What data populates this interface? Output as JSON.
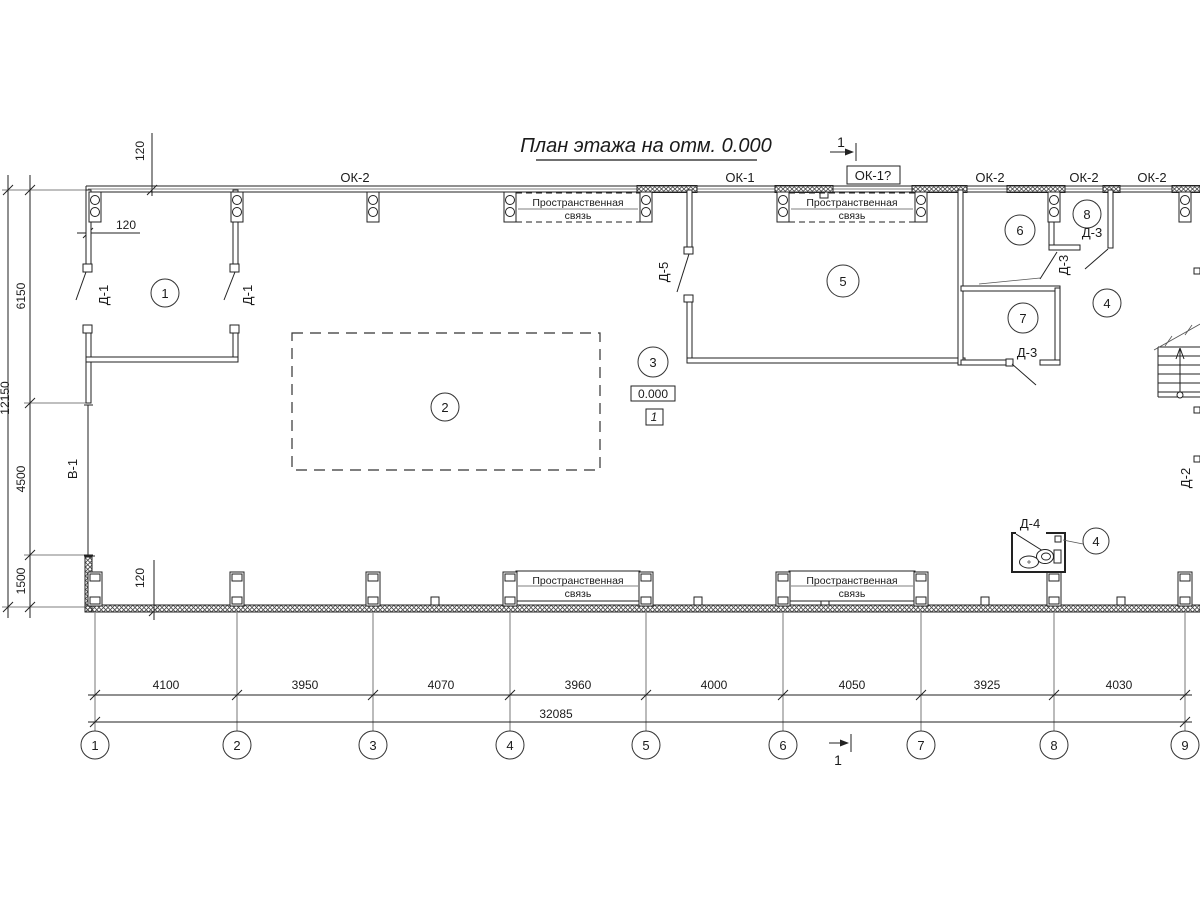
{
  "title": {
    "text": "План этажа на отм. 0.000"
  },
  "section_marks": {
    "top": "1",
    "bottom": "1"
  },
  "windows": {
    "ok2_a": "ОК-2",
    "ok1": "ОК-1",
    "ok1q": "ОК-1?",
    "ok2_b": "ОК-2",
    "ok2_c": "ОК-2",
    "ok2_d": "ОК-2"
  },
  "doors": {
    "d1_left": "Д-1",
    "d1_right": "Д-1",
    "d5": "Д-5",
    "d3_room8": "Д-3",
    "d3_mid": "Д-3",
    "d3_room7": "Д-3",
    "d4": "Д-4",
    "d2": "Д-2",
    "v1": "В-1"
  },
  "rooms": {
    "r1": "1",
    "r2": "2",
    "r3": "3",
    "r4a": "4",
    "r4b": "4",
    "r5": "5",
    "r6": "6",
    "r7": "7",
    "r8": "8"
  },
  "elevation": {
    "value": "0.000",
    "zone": "1"
  },
  "ties": {
    "line1": "Пространственная",
    "line2": "связь"
  },
  "dims": {
    "h": [
      "4100",
      "3950",
      "4070",
      "3960",
      "4000",
      "4050",
      "3925",
      "4030"
    ],
    "total": "32085",
    "v": [
      "6150",
      "4500",
      "1500"
    ],
    "v_total": "12150",
    "t120_top_v": "120",
    "t120_top_h": "120",
    "t120_bottom": "120"
  },
  "grid": {
    "axes": [
      "1",
      "2",
      "3",
      "4",
      "5",
      "6",
      "7",
      "8",
      "9"
    ]
  }
}
